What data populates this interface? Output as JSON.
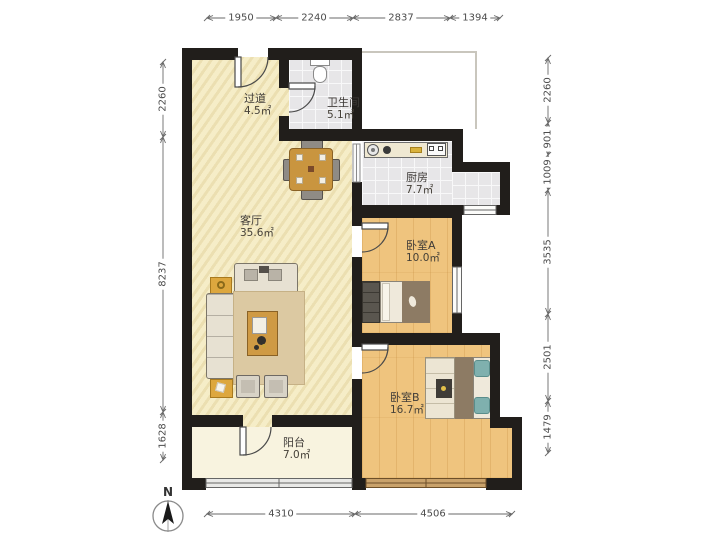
{
  "compass": {
    "label": "N"
  },
  "rooms": {
    "hallway": {
      "name": "过道",
      "area": "4.5㎡"
    },
    "bathroom": {
      "name": "卫生间",
      "area": "5.1㎡"
    },
    "kitchen": {
      "name": "厨房",
      "area": "7.7㎡"
    },
    "living": {
      "name": "客厅",
      "area": "35.6㎡"
    },
    "bedroomA": {
      "name": "卧室A",
      "area": "10.0㎡"
    },
    "bedroomB": {
      "name": "卧室B",
      "area": "16.7㎡"
    },
    "balcony": {
      "name": "阳台",
      "area": "7.0㎡"
    }
  },
  "dimensions": {
    "top": [
      "1950",
      "2240",
      "2837",
      "1394"
    ],
    "bottom": [
      "4310",
      "4506"
    ],
    "left": [
      "2260",
      "8237",
      "1628"
    ],
    "right": [
      "2260",
      "901",
      "1009",
      "3535",
      "2501",
      "1479"
    ]
  },
  "colors": {
    "wall": "#211e1b",
    "floor_living": "#f4ebc4",
    "floor_wood": "#efc47e",
    "floor_tile": "#e7e6e8",
    "floor_balcony": "#f8f3df",
    "furniture_accent": "#dda73e",
    "dimension_text": "#4c4c4c"
  }
}
